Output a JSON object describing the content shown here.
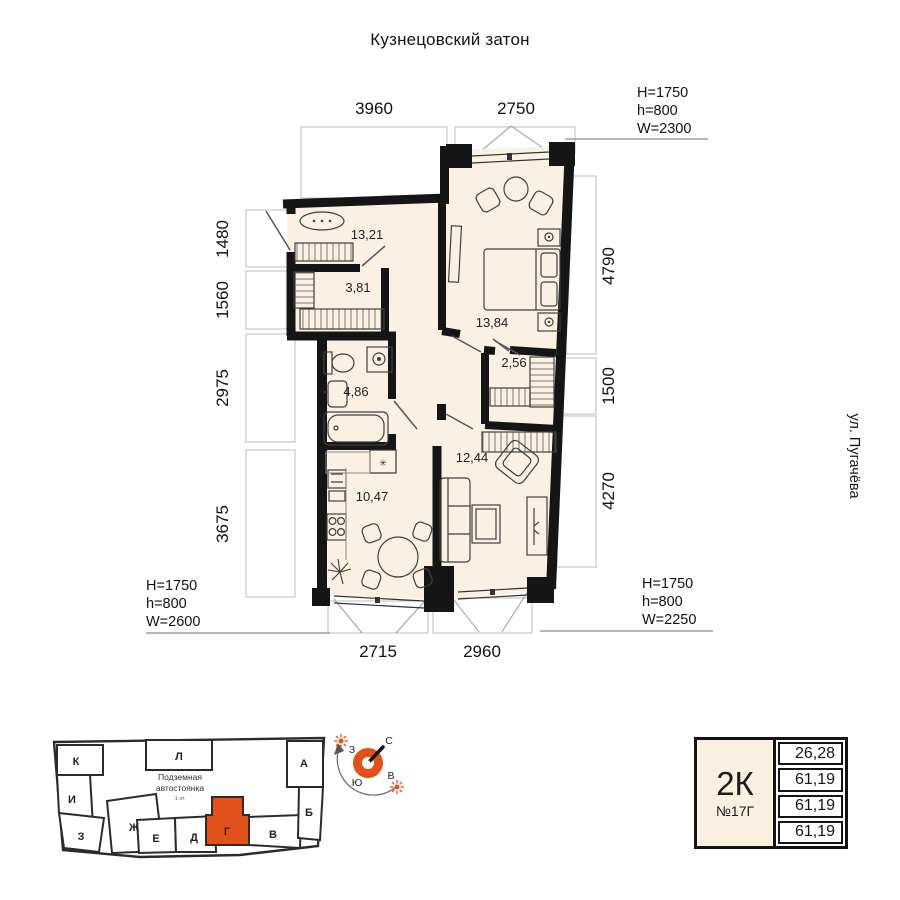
{
  "title": "Кузнецовский затон",
  "street_label": "ул. Пугачёва",
  "plan": {
    "room_areas": {
      "hallway": "13,21",
      "wardrobe": "3,81",
      "bedroom": "13,84",
      "bathroom": "4,86",
      "closet": "2,56",
      "living": "12,44",
      "kitchen": "10,47"
    },
    "dim_top": [
      "3960",
      "2750"
    ],
    "dim_left": [
      "1480",
      "1560",
      "2975",
      "3675"
    ],
    "dim_right": [
      "4790",
      "1500",
      "4270"
    ],
    "dim_bottom": [
      "2715",
      "2960"
    ],
    "window_specs": {
      "top_right": [
        "H=1750",
        "h=800",
        "W=2300"
      ],
      "bottom_left": [
        "H=1750",
        "h=800",
        "W=2600"
      ],
      "bottom_right": [
        "H=1750",
        "h=800",
        "W=2250"
      ]
    },
    "vent_symbol": "✳"
  },
  "footprint": {
    "sections": [
      "К",
      "И",
      "З",
      "Ж",
      "Л",
      "Е",
      "Д",
      "Г",
      "В",
      "А",
      "Б"
    ],
    "highlighted_section": "Г",
    "parking_label_line1": "Подземная",
    "parking_label_line2": "автостоянка",
    "parking_sublabel": "1 эт."
  },
  "compass": {
    "n": "С",
    "s": "Ю",
    "w": "З",
    "e": "В"
  },
  "info_card": {
    "type": "2К",
    "number": "№17Г",
    "values": [
      "26,28",
      "61,19",
      "61,19",
      "61,19"
    ]
  },
  "colors": {
    "accent": "#E1511C",
    "room_fill": "#FAF1E3",
    "wall": "#151515"
  }
}
